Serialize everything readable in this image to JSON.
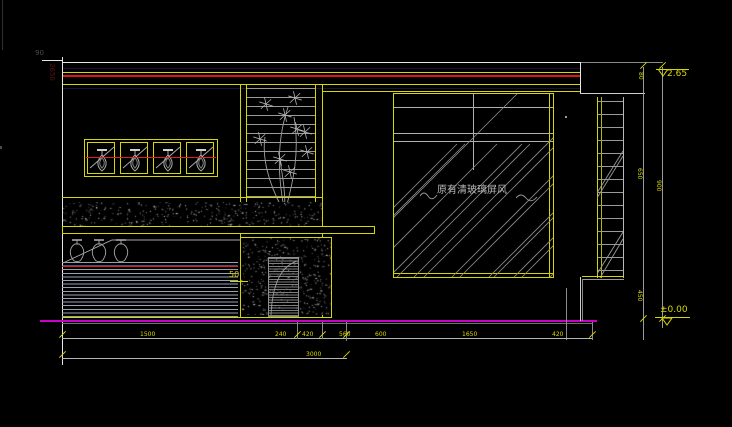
{
  "drawing": {
    "glass_annotation": "原有清玻璃屏风",
    "cabinet_note": "50",
    "corner_note": "90",
    "left_dim": "2650"
  },
  "levels": {
    "top": "2.65",
    "bottom": "±0.00"
  },
  "dims": {
    "bottom": [
      "1500",
      "240",
      "420",
      "560",
      "600",
      "1650",
      "420"
    ],
    "total": "3000",
    "right": [
      "80",
      "650",
      "900",
      "450"
    ]
  },
  "colors": {
    "line": "#e6e6e6",
    "yellow": "#d6d600",
    "red": "#de1515",
    "magenta": "#c800c8",
    "gray": "#9a9a9a"
  }
}
